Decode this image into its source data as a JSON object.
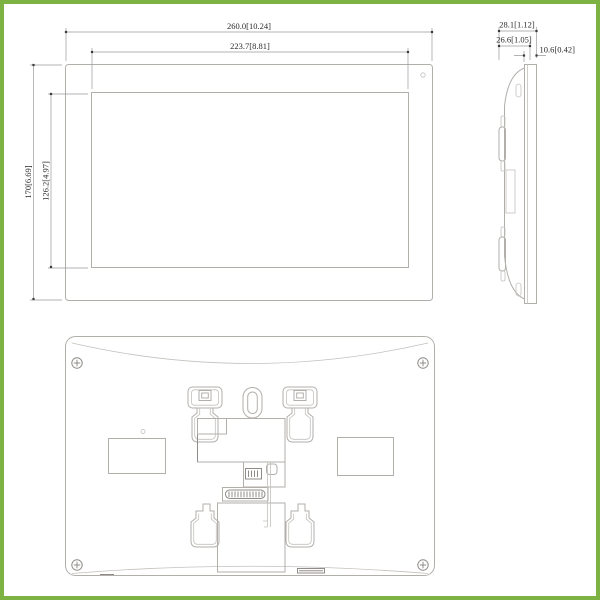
{
  "page": {
    "frame_color": "#7cb342",
    "background_color": "#ffffff",
    "line_color": "#b2afab",
    "dimension_text_color": "#2b2b2b"
  },
  "drawing": {
    "dimensions": {
      "front": {
        "overall_width": "260.0[10.24]",
        "display_width": "223.7[8.81]",
        "overall_height": "170[6.69]",
        "display_height": "126.2[4.97]"
      },
      "side": {
        "overall_depth": "28.1[1.12]",
        "body_depth": "26.6[1.05]",
        "panel_depth": "10.6[0.42]"
      }
    }
  }
}
